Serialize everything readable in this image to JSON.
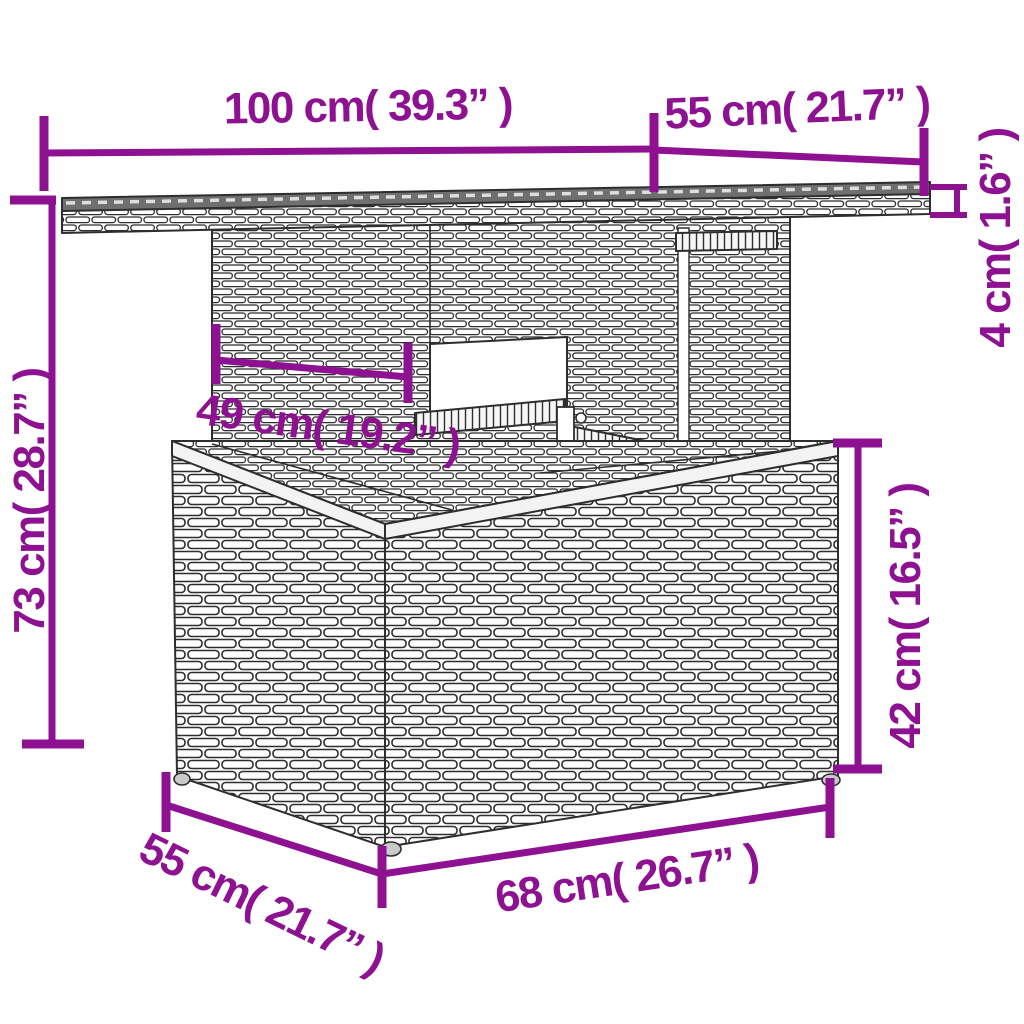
{
  "figure": {
    "type": "product-dimension-diagram",
    "subject": "rattan wicker garden table line drawing",
    "accent_color": "#8e1192",
    "line_color": "#2e2e2e",
    "background": "#ffffff"
  },
  "dimensions": [
    {
      "id": "tabletop-width",
      "cm": 100,
      "inch": 39.3,
      "label": "100 cm( 39.3”  )"
    },
    {
      "id": "tabletop-depth",
      "cm": 55,
      "inch": 21.7,
      "label": "55 cm( 21.7”  )"
    },
    {
      "id": "tabletop-thickness",
      "cm": 4,
      "inch": 1.6,
      "label": "4 cm( 1.6”  )"
    },
    {
      "id": "total-height",
      "cm": 73,
      "inch": 28.7,
      "label": "73 cm( 28.7”  )"
    },
    {
      "id": "pedestal-width",
      "cm": 49,
      "inch": 19.2,
      "label": "49 cm( 19.2”  )"
    },
    {
      "id": "base-height",
      "cm": 42,
      "inch": 16.5,
      "label": "42 cm( 16.5”  )"
    },
    {
      "id": "base-width",
      "cm": 68,
      "inch": 26.7,
      "label": "68 cm( 26.7”  )"
    },
    {
      "id": "base-depth",
      "cm": 55,
      "inch": 21.7,
      "label": "55 cm( 21.7”  )"
    }
  ]
}
